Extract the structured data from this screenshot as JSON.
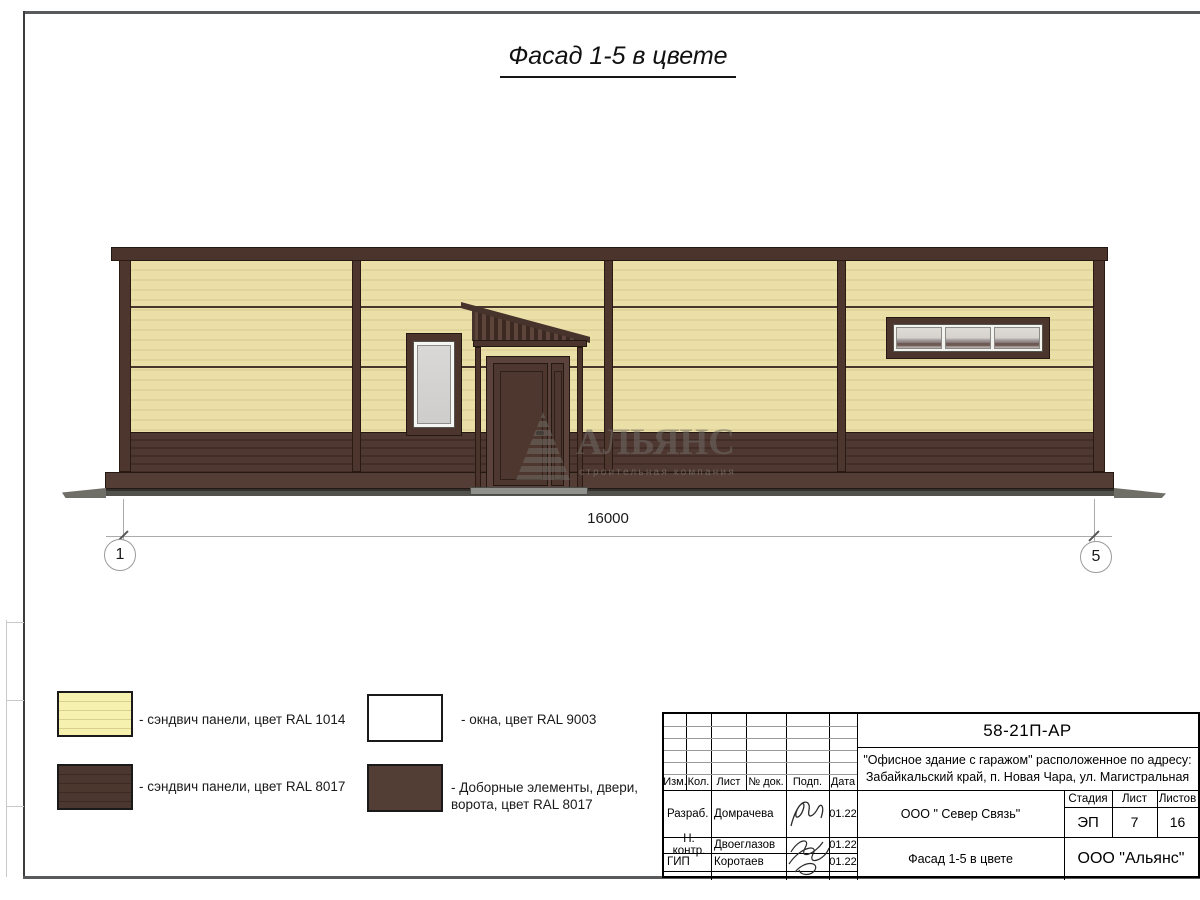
{
  "page": {
    "title": "Фасад 1-5 в цвете"
  },
  "dimension": {
    "length": "16000",
    "axis_left": "1",
    "axis_right": "5"
  },
  "watermark": {
    "name": "АЛЬЯНС",
    "tagline": "строительная компания"
  },
  "legend": {
    "items": [
      {
        "label": "- сэндвич панели, цвет RAL 1014"
      },
      {
        "label": "- сэндвич панели, цвет RAL 8017"
      },
      {
        "label": "- окна, цвет RAL 9003"
      },
      {
        "label_line1": "- Доборные элементы, двери,",
        "label_line2": "ворота, цвет RAL 8017"
      }
    ]
  },
  "titleblock": {
    "doc_code": "58-21П-АР",
    "project_line1": "\"Офисное здание с гаражом\" расположенное по адресу:",
    "project_line2": "Забайкальский край, п. Новая Чара, ул. Магистральная",
    "col_headers": {
      "izm": "Изм.",
      "kol": "Кол.",
      "list": "Лист",
      "dok": "№ док.",
      "podp": "Подп.",
      "data": "Дата"
    },
    "rows": [
      {
        "role": "Разраб.",
        "name": "Домрачева",
        "date": "01.22"
      },
      {
        "role": "Н. контр.",
        "name": "Двоеглазов",
        "date": "01.22"
      },
      {
        "role": "ГИП",
        "name": "Коротаев",
        "date": "01.22"
      }
    ],
    "contractor": "ООО \" Север Связь\"",
    "sheet_name": "Фасад 1-5 в цвете",
    "stage_label": "Стадия",
    "stage_value": "ЭП",
    "sheet_label": "Лист",
    "sheet_value": "7",
    "sheets_label": "Листов",
    "sheets_value": "16",
    "org_name": "ООО \"Альянс\""
  },
  "colors": {
    "panel_cream_ral1014": "#ebdfa8",
    "panel_brown_ral8017": "#4a342c",
    "window_ral9003": "#ffffff",
    "glass": "#d4d3d1",
    "ground": "#52514b"
  }
}
